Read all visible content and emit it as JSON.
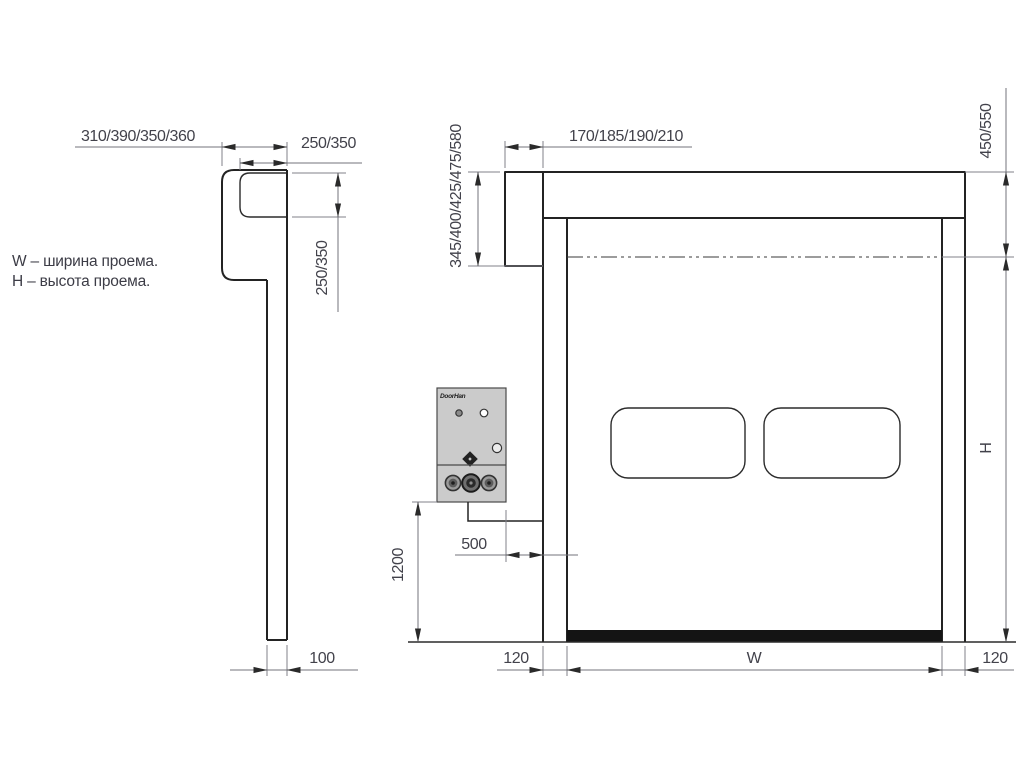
{
  "drawing": {
    "legend": {
      "width_note": "W – ширина проема.",
      "height_note": "H – высота проема."
    },
    "side_view": {
      "dim_hood_depth": "310/390/350/360",
      "dim_roll_horizontal": "250/350",
      "dim_roll_vertical": "250/350",
      "dim_rail_width": "100"
    },
    "front_view": {
      "dim_bracket_width": "170/185/190/210",
      "dim_bracket_height": "345/400/425/475/580",
      "dim_box_top_to_axis": "450/550",
      "dim_opening_height": "H",
      "dim_control_offset": "500",
      "dim_control_height": "1200",
      "dim_left_column": "120",
      "dim_opening_width": "W",
      "dim_right_column": "120",
      "control_box_brand": "DoorHan"
    },
    "colors": {
      "outline": "#232323",
      "dimension_line": "#73737b",
      "dimension_text": "#42424b",
      "bottom_seal": "#141414",
      "control_box_fill": "#cbcbcb"
    }
  }
}
